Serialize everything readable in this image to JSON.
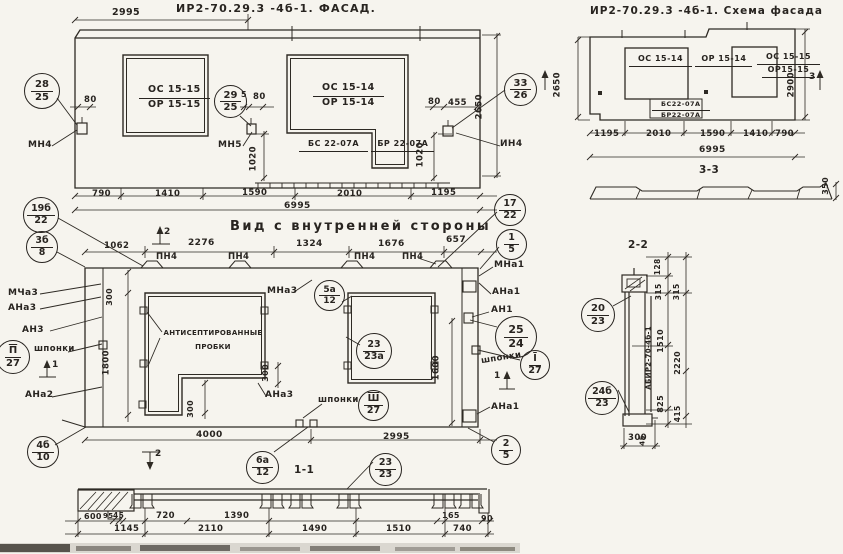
{
  "drawing": {
    "background": "#f6f4ee",
    "ink": "#282420"
  },
  "facade": {
    "title": "ИР2-70.29.3 -4б-1.  ФАСАД.",
    "windows": {
      "w1": {
        "top": "ОС 15-15",
        "bottom": "ОР 15-15"
      },
      "w2": {
        "top": "ОС 15-14",
        "bottom": "ОР 15-14"
      },
      "w3": {
        "top": "БС 22-07А",
        "bottom": "БР 22-07А"
      }
    },
    "anchor_labels": {
      "mn4": "МН4",
      "mn5": "МН5",
      "in4": "ИН4"
    },
    "callouts": {
      "c28": {
        "n": "28",
        "d": "25"
      },
      "c29": {
        "n": "29",
        "d": "25"
      },
      "c33": {
        "n": "33",
        "d": "26"
      }
    },
    "dims": {
      "w2995": "2995",
      "left80": "80",
      "mid5": "5",
      "mid80": "80",
      "right80": "80",
      "right455": "455",
      "v1020a": "1020",
      "v1020b": "1020",
      "v2650": "2650",
      "b790": "790",
      "b1410": "1410",
      "b1590": "1590",
      "b2010": "2010",
      "b1195": "1195",
      "total": "6995"
    }
  },
  "scheme": {
    "title": "ИР2-70.29.3 -4б-1. Схема фасада",
    "windows": {
      "w1": {
        "top": "ОС 15-14",
        "bottom": "ОР 15-14"
      },
      "w2": {
        "top": "ОС 15-15",
        "bottom": "ОР15-15"
      },
      "w3": {
        "top": "БС22-07А",
        "bottom": "БР22-07А"
      }
    },
    "dims": {
      "v2650": "2650",
      "v2900": "2900",
      "b1195": "1195",
      "b2010": "2010",
      "b1590": "1590",
      "b1410": "1410",
      "b790": "790",
      "total": "6995",
      "profile350": "350"
    },
    "marker3": "3",
    "section_label": "3-3"
  },
  "inner": {
    "title": "Вид с внутренней стороны",
    "plugs": {
      "line1": "АНТИСЕПТИРОВАННЫЕ",
      "line2": "ПРОБКИ"
    },
    "pn4": "ПН4",
    "labels": {
      "mcha3": "МЧа3",
      "ana3": "АНа3",
      "an3": "АН3",
      "shponki": "шпонки",
      "ana2": "АНа2",
      "mna3": "МНа3",
      "mna1": "МНа1",
      "ana1": "АНа1",
      "an1": "АН1"
    },
    "dims": {
      "t1062": "1062",
      "t2276": "2276",
      "t1324": "1324",
      "t1676": "1676",
      "t657": "657",
      "v300": "300",
      "v1800": "1800",
      "v1600": "1600",
      "b4000": "4000",
      "b2995": "2995"
    },
    "markers": {
      "m1": "1",
      "m2": "2"
    },
    "section_label": "1-1",
    "callouts": {
      "c19b": {
        "n": "19б",
        "d": "22"
      },
      "c3b": {
        "n": "3б",
        "d": "8"
      },
      "c17": {
        "n": "17",
        "d": "22"
      },
      "c1": {
        "n": "1",
        "d": "5"
      },
      "c5a": {
        "n": "5а",
        "d": "12"
      },
      "c23a": {
        "n": "23",
        "d": "23а"
      },
      "c25": {
        "n": "25",
        "d": "24"
      },
      "cI": {
        "n": "I",
        "d": "27"
      },
      "cII": {
        "n": "П",
        "d": "27"
      },
      "cIII": {
        "n": "Ш",
        "d": "27"
      },
      "c4b": {
        "n": "4б",
        "d": "10"
      },
      "c6a": {
        "n": "6а",
        "d": "12"
      },
      "c2": {
        "n": "2",
        "d": "5"
      },
      "c23": {
        "n": "23",
        "d": "23"
      }
    }
  },
  "section22": {
    "label": "2-2",
    "stamp": "АБИР2-70-4б-1",
    "callouts": {
      "c20": {
        "n": "20",
        "d": "23"
      },
      "c24b": {
        "n": "24б",
        "d": "23"
      }
    },
    "dims": {
      "d128": "128",
      "d315a": "315",
      "d315b": "315",
      "d1510": "1510",
      "d2220": "2220",
      "d825": "825",
      "d415": "415",
      "d45": "45",
      "d300": "300"
    }
  },
  "section11": {
    "row1": {
      "d600": "600",
      "d95": "95",
      "d45": "45",
      "d720": "720",
      "d1390": "1390",
      "d165": "165",
      "d90": "90"
    },
    "row2": {
      "d1145": "1145",
      "d2110": "2110",
      "d1490": "1490",
      "d1510": "1510",
      "d740": "740"
    }
  }
}
